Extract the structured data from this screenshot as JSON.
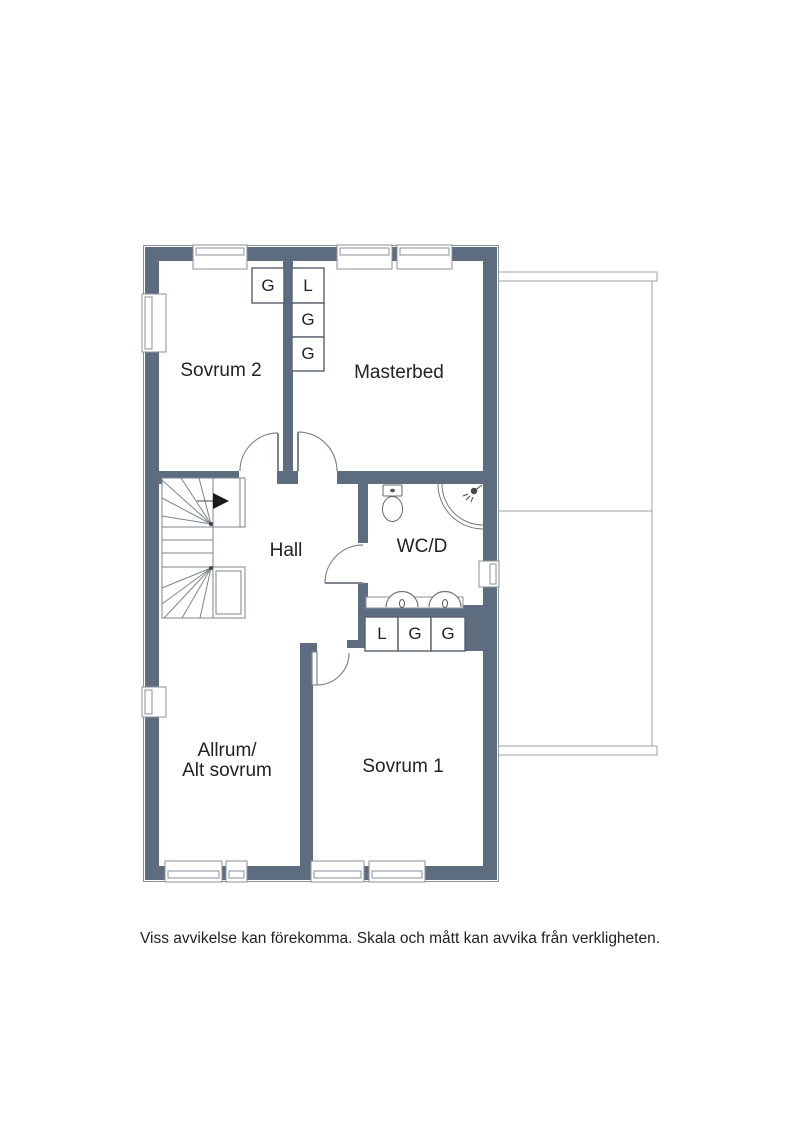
{
  "colors": {
    "wall": "#5d6c7e",
    "line": "#8a919b",
    "thin": "#7d858f",
    "text": "#222222",
    "arrow": "#1a1a1a"
  },
  "rooms": {
    "sovrum2": {
      "label": "Sovrum 2",
      "closets": [
        "G"
      ]
    },
    "masterbed": {
      "label": "Masterbed",
      "closets": [
        "L",
        "G",
        "G"
      ]
    },
    "hall": {
      "label": "Hall"
    },
    "wcd": {
      "label": "WC/D"
    },
    "allrum": {
      "label_lines": [
        "Allrum/",
        "Alt sovrum"
      ]
    },
    "sovrum1": {
      "label": "Sovrum 1",
      "closets": [
        "L",
        "G",
        "G"
      ]
    }
  },
  "fixtures": [
    "stairs-with-up-arrow",
    "toilet",
    "corner-shower",
    "double-sinks",
    "terrace-roof-outline"
  ],
  "footer": {
    "disclaimer": "Viss avvikelse kan förekomma. Skala och mått kan avvika från verkligheten."
  }
}
